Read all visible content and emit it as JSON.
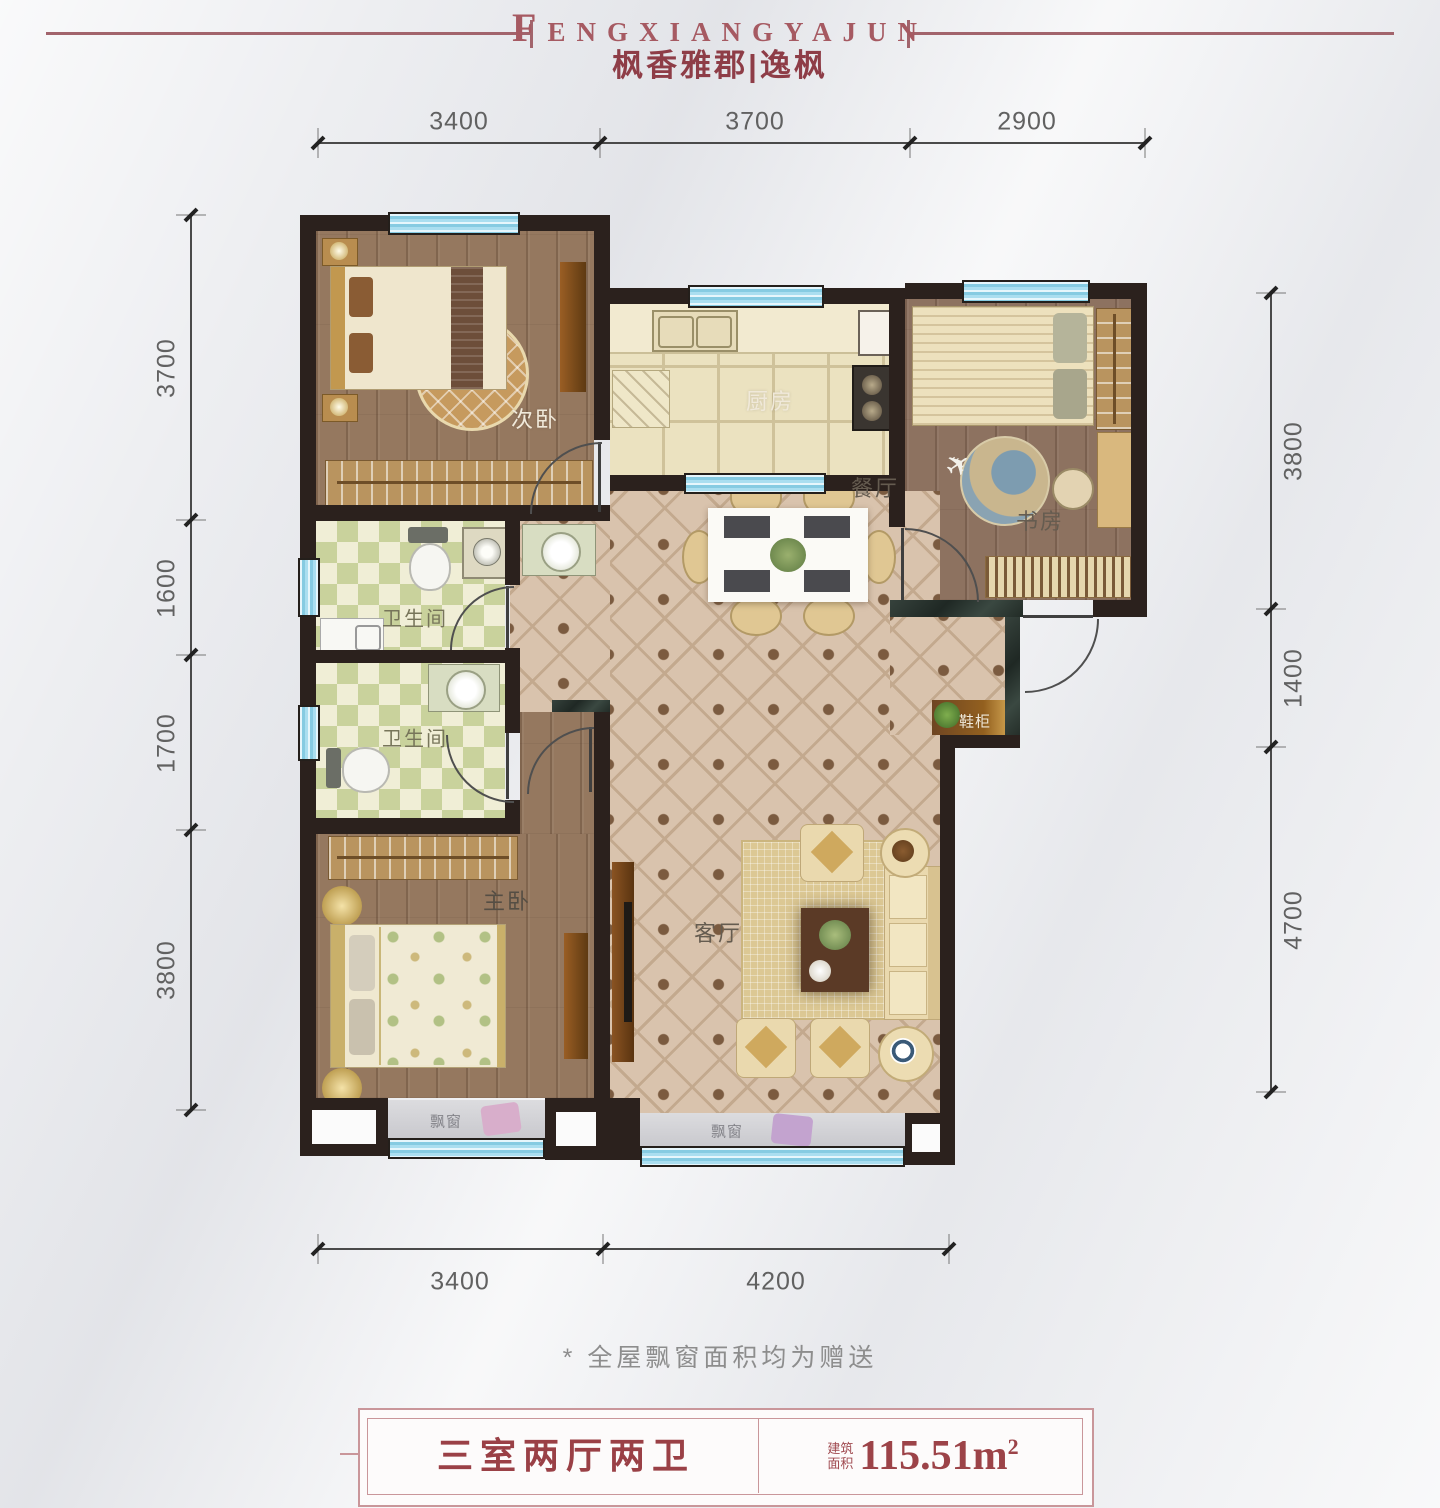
{
  "header": {
    "brand_en": "FENGXIANGYAJUN",
    "brand_cn": "枫香雅郡|逸枫"
  },
  "dims": {
    "top": [
      "3400",
      "3700",
      "2900"
    ],
    "left": [
      "3700",
      "1600",
      "1700",
      "3800"
    ],
    "right": [
      "3800",
      "1400",
      "4700"
    ],
    "bottom": [
      "3400",
      "4200"
    ]
  },
  "rooms": {
    "secondary_bedroom": "次卧",
    "kitchen": "厨房",
    "study": "书房",
    "dining": "餐厅",
    "bathroom": "卫生间",
    "master_bedroom": "主卧",
    "living": "客厅",
    "bay_window": "飘窗",
    "shoe_cabinet": "鞋柜"
  },
  "footer": {
    "note": "* 全屋飘窗面积均为赠送",
    "layout": "三室两厅两卫",
    "area_label_line1": "建筑",
    "area_label_line2": "面积",
    "area_value": "115.51m",
    "area_sup": "2"
  },
  "colors": {
    "accent_red": "#9c4348",
    "border_pink": "#c9969a",
    "wall_dark": "#2b211d",
    "window_blue": "#86cbe2",
    "dim_text": "#616161",
    "wood_floor": "#95785f",
    "dining_tile": "#d9c3ad",
    "bath_tile": "#c9d29c",
    "kitchen_tile": "#ebe2c0"
  }
}
